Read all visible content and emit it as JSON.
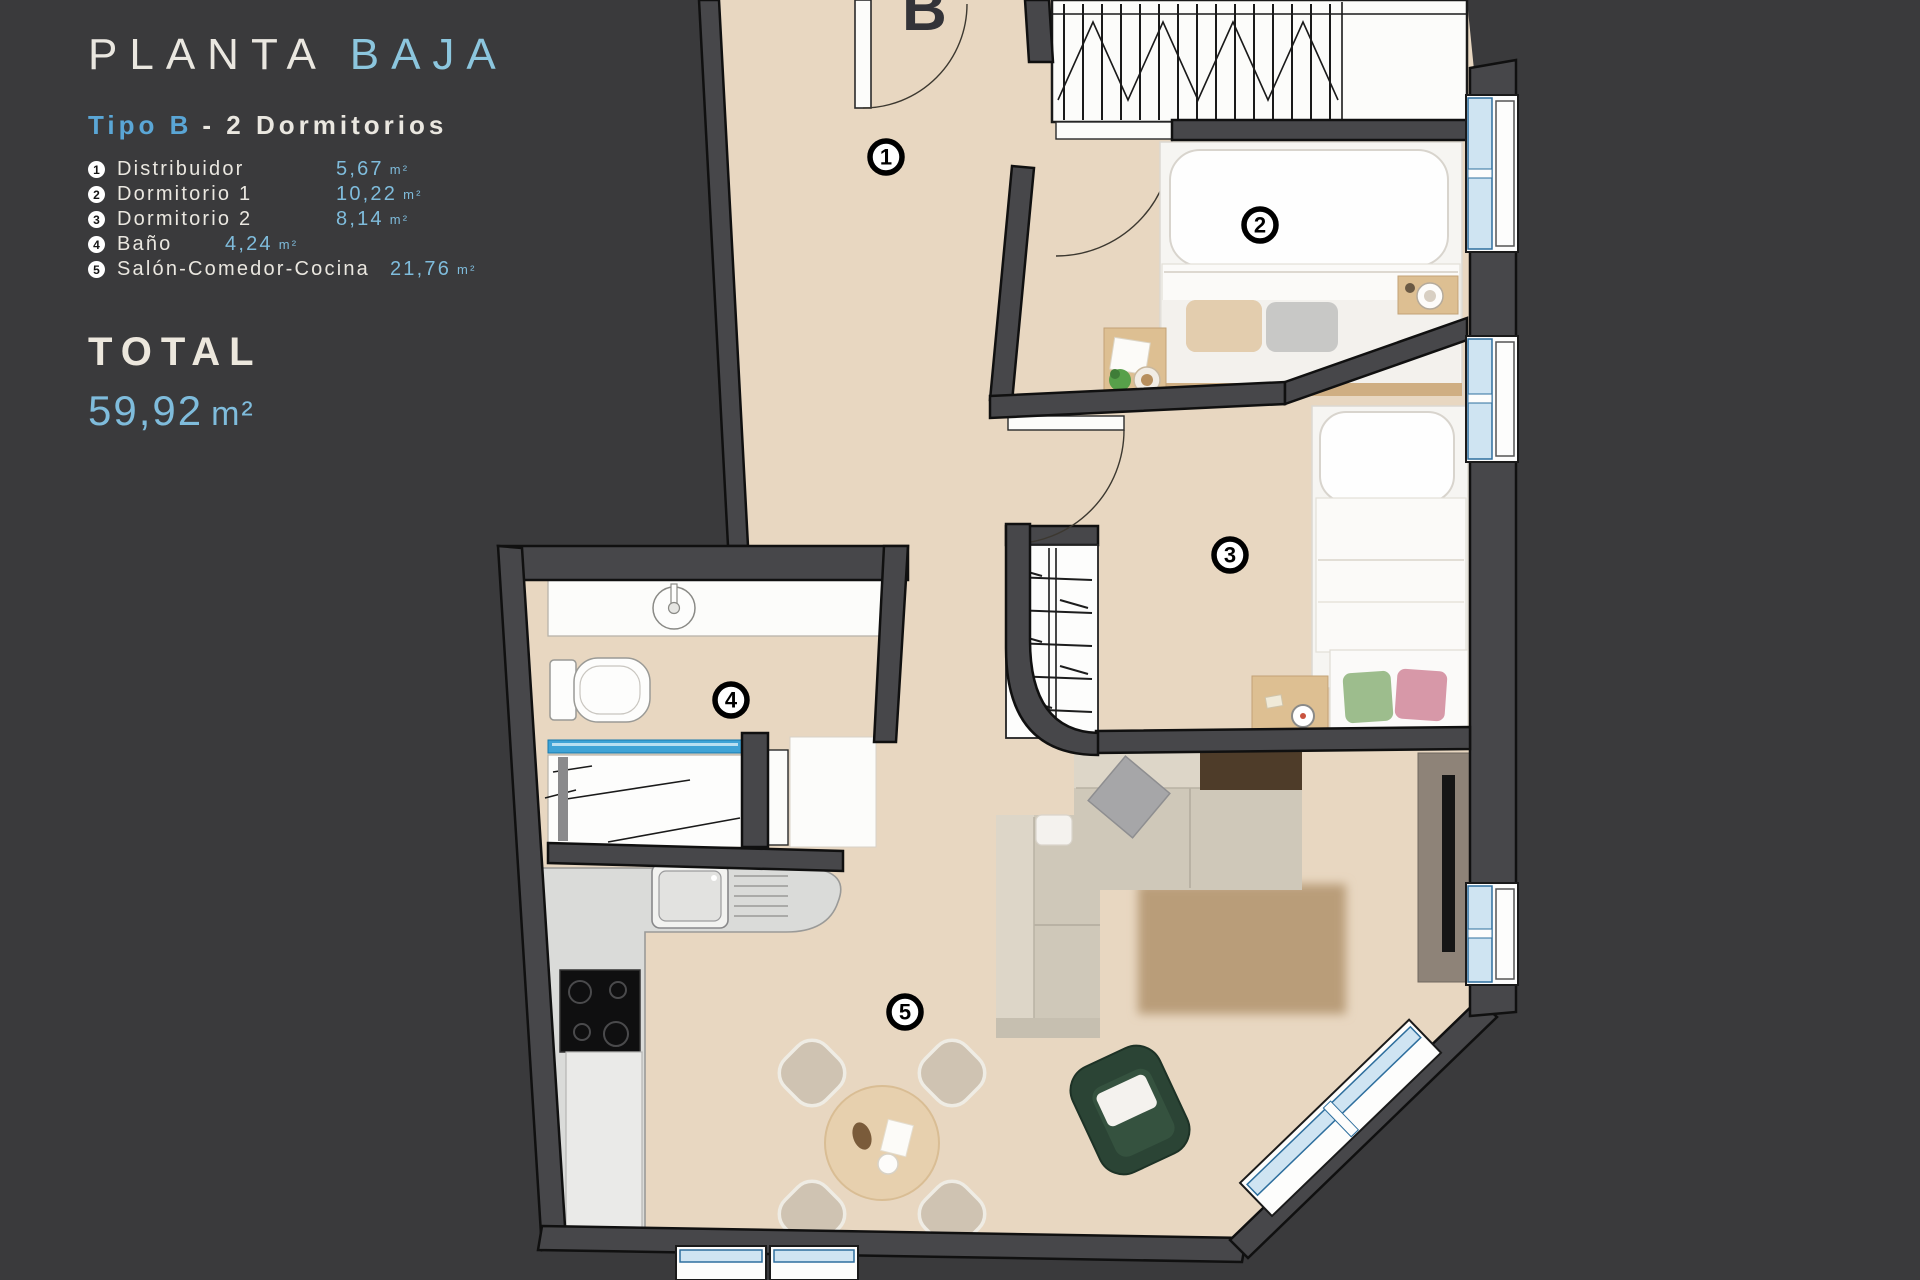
{
  "panel": {
    "title": {
      "main": "PLANTA",
      "accent": "BAJA"
    },
    "subtitle": {
      "accent": "Tipo B",
      "rest": "- 2  Dormitorios"
    },
    "rooms": [
      {
        "num": "1",
        "name": "Distribuidor",
        "value": "5,67",
        "unit": "m²"
      },
      {
        "num": "2",
        "name": "Dormitorio 1",
        "value": "10,22",
        "unit": "m²"
      },
      {
        "num": "3",
        "name": "Dormitorio 2",
        "value": "8,14",
        "unit": "m²"
      },
      {
        "num": "4",
        "name": "Baño",
        "value": "4,24",
        "unit": "m²"
      },
      {
        "num": "5",
        "name": "Salón-Comedor-Cocina",
        "value": "21,76",
        "unit": "m²"
      }
    ],
    "total_label": "TOTAL",
    "total": {
      "value": "59,92",
      "unit": "m²"
    }
  },
  "plan": {
    "unit_label": "B",
    "room_badges": [
      "1",
      "2",
      "3",
      "4",
      "5"
    ]
  },
  "colors": {
    "background": "#3a3a3c",
    "text": "#eae7e0",
    "accent_blue": "#7fbcdc",
    "accent_blue_strong": "#5aa6d6",
    "floor": "#e8d7c1",
    "wall": "#47474a",
    "window_blue": "#cfe4f2",
    "window_frame": "#2e6f9e",
    "shower_glass_blue": "#3fa3d6"
  }
}
